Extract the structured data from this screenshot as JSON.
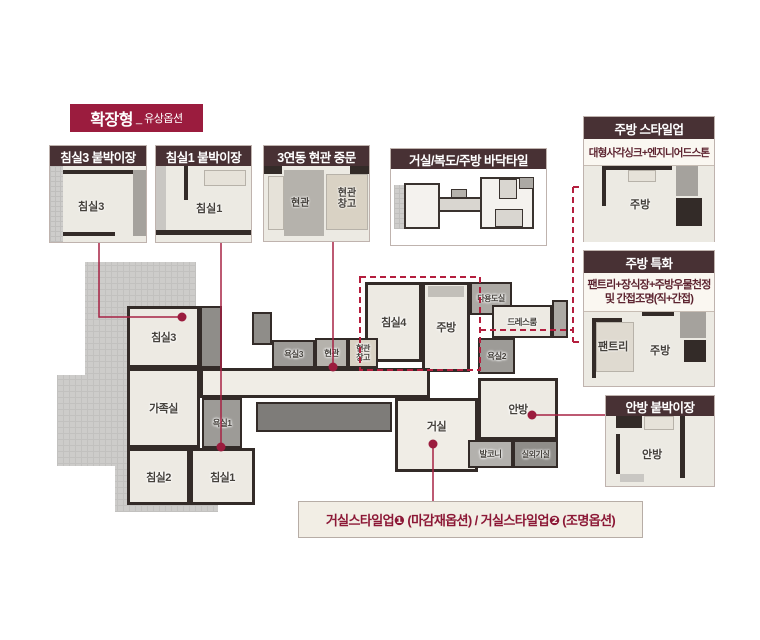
{
  "title": {
    "main": "확장형",
    "sub": "_ 유상옵션"
  },
  "boxes": {
    "bed3": {
      "header": "침실3 붙박이장",
      "room": "침실3"
    },
    "bed1": {
      "header": "침실1 붙박이장",
      "room": "침실1"
    },
    "door": {
      "header": "3연동 현관 중문",
      "entry": "현관",
      "storage": "현관창고"
    },
    "tile": {
      "header": "거실/복도/주방 바닥타일"
    },
    "kitchen_style": {
      "header": "주방 스타일업",
      "subtitle": "대형사각싱크+엔지니어드스톤",
      "room": "주방"
    },
    "kitchen_special": {
      "header": "주방 특화",
      "subtitle1": "팬트리+장식장+주방우물천정",
      "subtitle2": "및 간접조명(직+간접)",
      "pantry": "팬트리",
      "room": "주방"
    },
    "master": {
      "header": "안방 붙박이장",
      "room": "안방"
    },
    "living_note": {
      "text": "거실스타일업❶ (마감재옵션) / 거실스타일업❷ (조명옵션)"
    }
  },
  "plan": {
    "rooms": {
      "bed3": "침실3",
      "family": "가족실",
      "bed2": "침실2",
      "bed1": "침실1",
      "bath1": "욕실1",
      "bath3": "욕실3",
      "entry": "현관",
      "entry_storage": "현관창고",
      "bed4": "침실4",
      "kitchen": "주방",
      "utility": "다용도실",
      "dressroom": "드레스룸",
      "bath2": "욕실2",
      "master": "안방",
      "living": "거실",
      "balcony": "발코니",
      "outdoor_unit": "실외기실"
    }
  },
  "colors": {
    "accent": "#9b1c3e",
    "header_bg": "#483134",
    "connector": "#a72244",
    "dashed": "#b41e3e"
  }
}
